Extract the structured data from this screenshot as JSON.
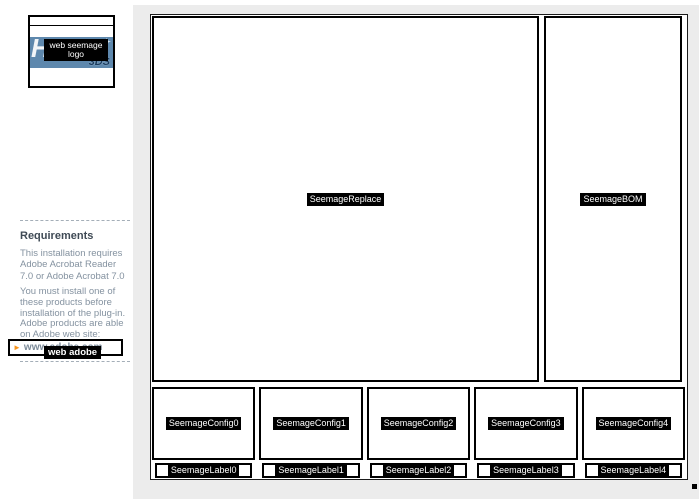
{
  "page": {
    "background_color": "#ececec",
    "panel_background": "#ffffff"
  },
  "logo": {
    "brand_text": "HR",
    "brand_sub": "3DS",
    "icon_glyph": "✈",
    "banner_color": "#5e88ad",
    "tooltip_line1": "web seemage",
    "tooltip_line2": "logo"
  },
  "sidebar": {
    "heading": "Requirements",
    "paragraph1_lines": [
      "This installation requires",
      "Adobe Acrobat Reader",
      "7.0 or Adobe Acrobat 7.0"
    ],
    "paragraph2_lines": [
      "You must install one of",
      "these products before",
      "installation of the plug-in.",
      "Adobe products are able",
      "on Adobe web site:"
    ],
    "link": {
      "bullet_glyph": "►",
      "bullet_color": "#f7941d",
      "text": "www.adobe.com",
      "tooltip": "web adobe"
    }
  },
  "main": {
    "viewport_label": "SeemageReplace",
    "bom_label": "SeemageBOM",
    "configs": [
      "SeemageConfig0",
      "SeemageConfig1",
      "SeemageConfig2",
      "SeemageConfig3",
      "SeemageConfig4"
    ],
    "labels": [
      "SeemageLabel0",
      "SeemageLabel1",
      "SeemageLabel2",
      "SeemageLabel3",
      "SeemageLabel4"
    ]
  }
}
